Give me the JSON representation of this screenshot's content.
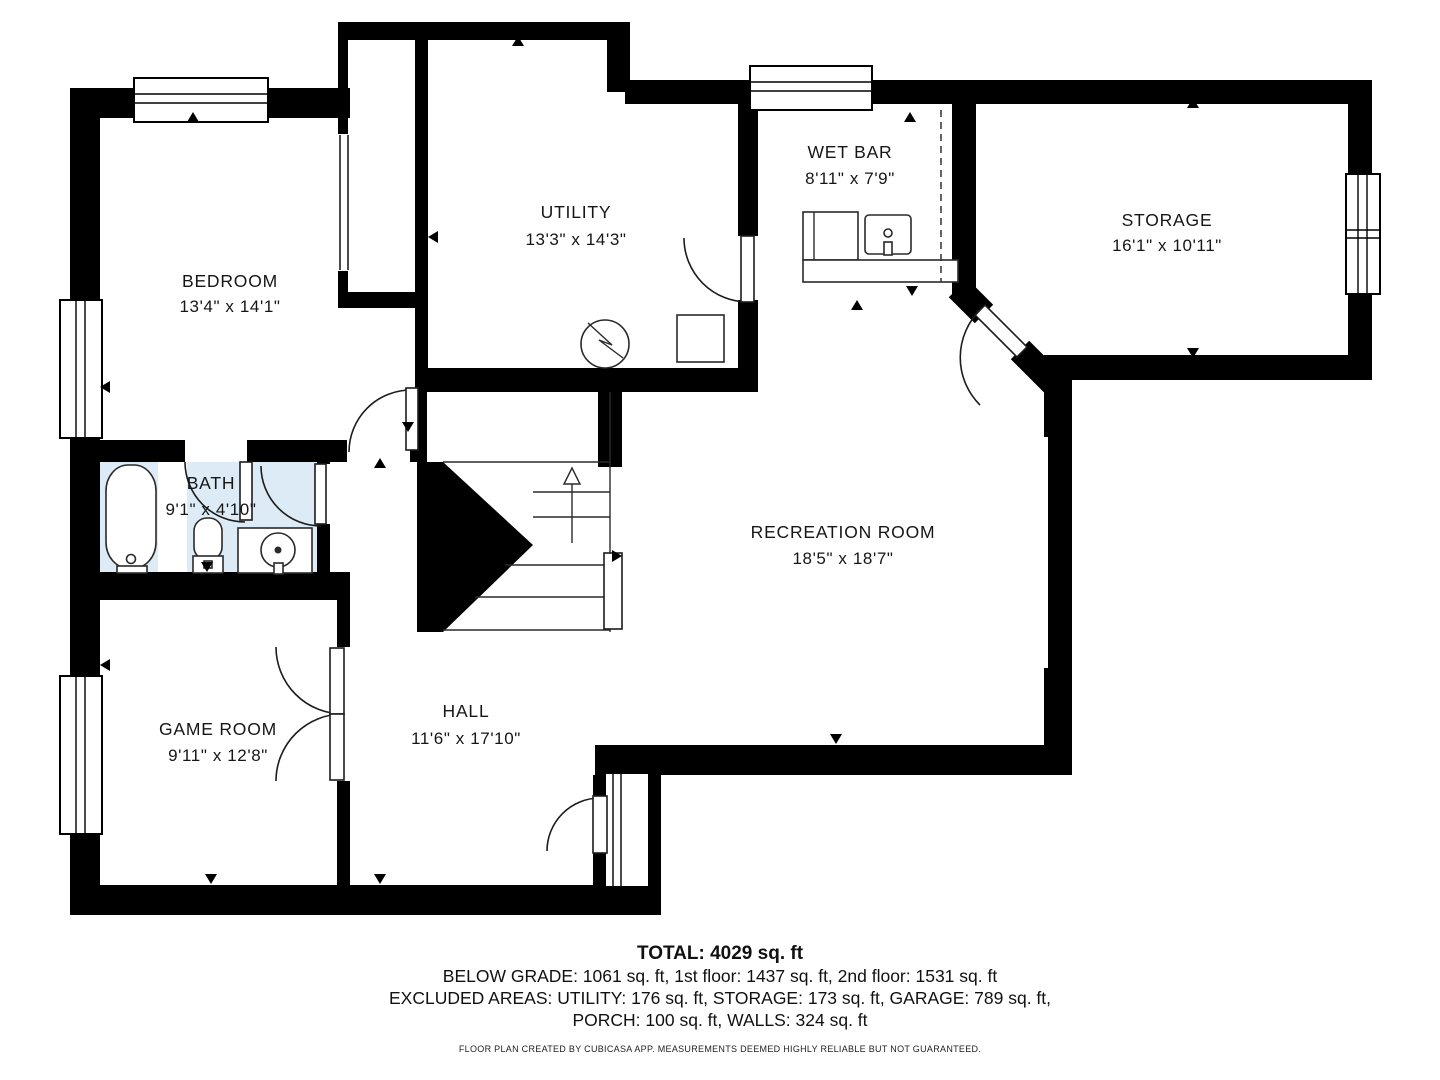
{
  "title": "Basement floor plan",
  "rooms": [
    {
      "name": "BEDROOM",
      "dims": "13'4\" x 14'1\""
    },
    {
      "name": "UTILITY",
      "dims": "13'3\" x 14'3\""
    },
    {
      "name": "WET BAR",
      "dims": "8'11\" x 7'9\""
    },
    {
      "name": "STORAGE",
      "dims": "16'1\" x 10'11\""
    },
    {
      "name": "BATH",
      "dims": "9'1\" x 4'10\""
    },
    {
      "name": "RECREATION ROOM",
      "dims": "18'5\" x 18'7\""
    },
    {
      "name": "GAME ROOM",
      "dims": "9'11\" x 12'8\""
    },
    {
      "name": "HALL",
      "dims": "11'6\" x 17'10\""
    }
  ],
  "footer": {
    "total": "TOTAL: 4029 sq. ft",
    "line1": "BELOW GRADE: 1061 sq. ft, 1st floor: 1437 sq. ft, 2nd floor: 1531 sq. ft",
    "line2": "EXCLUDED AREAS: UTILITY: 176 sq. ft, STORAGE: 173 sq. ft, GARAGE: 789 sq. ft,",
    "line3": "PORCH: 100 sq. ft, WALLS: 324 sq. ft",
    "disclaimer": "FLOOR PLAN CREATED BY CUBICASA APP. MEASUREMENTS DEEMED HIGHLY RELIABLE BUT NOT GUARANTEED."
  },
  "colors": {
    "wall": "#000000",
    "bath_floor": "#dcebf5",
    "background": "#ffffff"
  }
}
